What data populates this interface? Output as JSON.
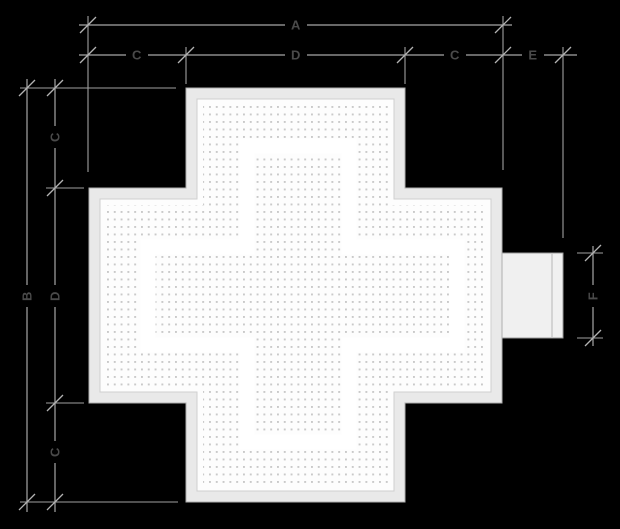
{
  "canvas": {
    "width": 620,
    "height": 529
  },
  "labels": {
    "top_total": "A",
    "top_left_arm": "C",
    "top_center": "D",
    "top_right_arm": "C",
    "top_bracket_depth": "E",
    "left_total": "B",
    "left_top_arm": "C",
    "left_center": "D",
    "left_bottom_arm": "C",
    "bracket_height": "F"
  },
  "colors": {
    "background": "#000000",
    "dimension_line": "#a6a6a6",
    "extension_line": "#9f9f9f",
    "tick": "#b3b3b3",
    "label_text": "#4a4a4a",
    "frame_fill": "#e9e9e9",
    "frame_outline": "#aeaeae",
    "panel_fill": "#fdfdfd",
    "panel_outline": "#cfcfcf",
    "led_dot": "#c9c9c9",
    "glyph_gap": "#ffffff",
    "bracket_fill": "#f0f0f0",
    "bracket_outline": "#9a9a9a"
  }
}
